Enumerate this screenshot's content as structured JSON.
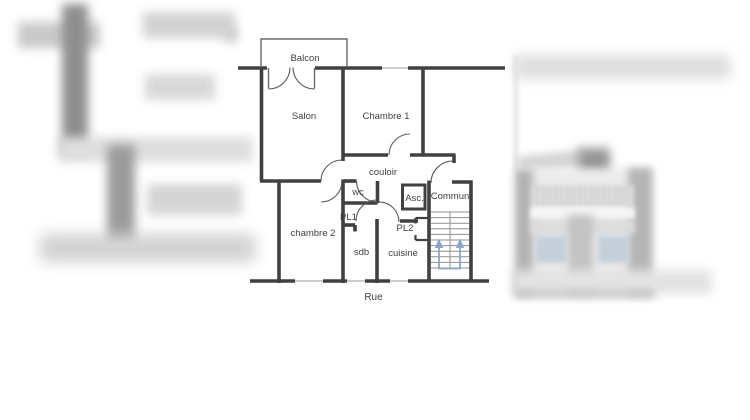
{
  "plan": {
    "labels": {
      "balcon": "Balcon",
      "salon": "Salon",
      "chambre1": "Chambre 1",
      "couloir": "couloir",
      "wc": "wc",
      "asc": "Asc.",
      "commun": "Commun",
      "pl1": "PL1",
      "pl2": "PL2",
      "chambre2": "chambre 2",
      "sdb": "sdb",
      "cuisine": "cuisine",
      "rue": "Rue"
    },
    "colors": {
      "wall": "#404040",
      "window_line": "#9a9a9a",
      "door_arc": "#5a5a5a",
      "text": "#3f3f3f",
      "stair_step": "#8f8f8f",
      "stair_arrow": "#8ba5c8"
    }
  },
  "side_images": {
    "left": {
      "description": "blurred floor-plan sketch"
    },
    "right": {
      "description": "blurred building facade photo"
    }
  }
}
